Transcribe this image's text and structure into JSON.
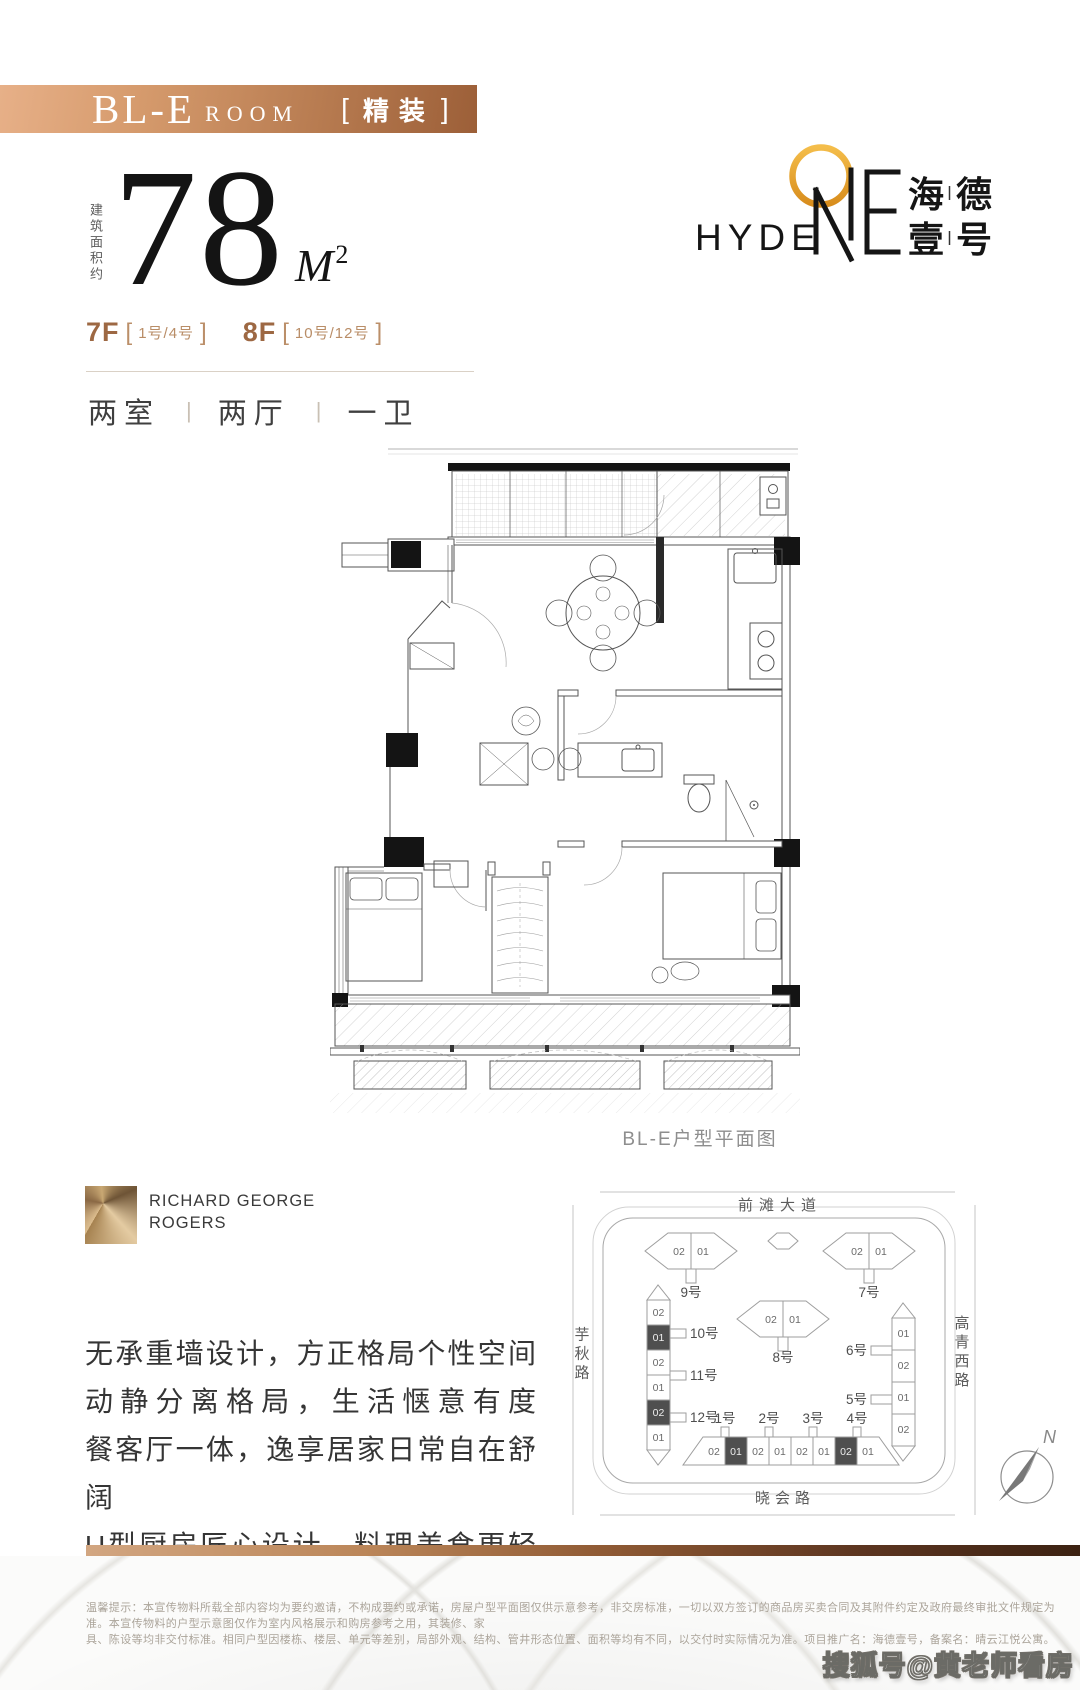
{
  "banner": {
    "model": "BL-E",
    "room": "ROOM",
    "bracket_open": "[",
    "tag": "精装",
    "bracket_close": "]"
  },
  "area": {
    "label_vertical": "建筑面积约",
    "value": "78",
    "unit": "M",
    "sup": "2"
  },
  "floors": {
    "f1": {
      "name": "7F",
      "open": "[",
      "units": "1号/4号",
      "close": "]"
    },
    "f2": {
      "name": "8F",
      "open": "[",
      "units": "10号/12号",
      "close": "]"
    }
  },
  "specs": {
    "s1": "两室",
    "sep1": "|",
    "s2": "两厅",
    "sep2": "|",
    "s3": "一卫"
  },
  "logo": {
    "hyde": "HYDE",
    "cn1": "海",
    "cn2": "德",
    "cn3": "壹",
    "cn4": "号"
  },
  "floorplan": {
    "caption": "BL-E户型平面图"
  },
  "architect": {
    "line1": "RICHARD GEORGE",
    "line2": "ROGERS"
  },
  "description": {
    "line1": "无承重墙设计，方正格局个性空间",
    "line2": "动静分离格局，生活惬意有度",
    "line3": "餐客厅一体，逸享居家日常自在舒阔",
    "line4": "U型厨房匠心设计，料理美食更轻松"
  },
  "sitemap": {
    "roads": {
      "top": "前滩大道",
      "bottom": "晓会路",
      "left": "芋秋路",
      "right": "高青西路"
    },
    "hex9": {
      "name": "9号",
      "c1": "02",
      "c2": "01"
    },
    "hex7": {
      "name": "7号",
      "c1": "02",
      "c2": "01"
    },
    "hex8": {
      "name": "8号",
      "c1": "02",
      "c2": "01"
    },
    "left_strip": {
      "b10": "10号",
      "b11": "11号",
      "b12": "12号",
      "cells": [
        "02",
        "01",
        "02",
        "01",
        "02",
        "01"
      ],
      "dark_cells": [
        1,
        4
      ]
    },
    "right_strip": {
      "b6": "6号",
      "b5": "5号",
      "cells": [
        "01",
        "02",
        "01",
        "02"
      ],
      "dark_cells": []
    },
    "bottom_strip": {
      "b1": "1号",
      "b2": "2号",
      "b3": "3号",
      "b4": "4号",
      "cells": [
        "02",
        "01",
        "02",
        "01",
        "02",
        "01",
        "02",
        "01"
      ],
      "dark_cells": [
        1,
        6
      ]
    },
    "compass": "N"
  },
  "disclaimer": {
    "line1": "温馨提示：本宣传物料所载全部内容均为要约邀请，不构成要约或承诺，房屋户型平面图仅供示意参考，非交房标准，一切以双方签订的商品房买卖合同及其附件约定及政府最终审批文件规定为准。本宣传物料的户型示意图仅作为室内风格展示和购房参考之用，其装修、家",
    "line2": "具、陈设等均非交付标准。相同户型因楼栋、楼层、单元等差别，局部外观、结构、管井形态位置、面积等均有不同，以交付时实际情况为准。项目推广名：海德壹号，备案名：晴云江悦公寓。"
  },
  "watermark": "搜狐号@黄老师看房",
  "colors": {
    "banner_gradient_start": "#e7b088",
    "banner_gradient_end": "#9c5f38",
    "accent_bronze": "#9d6843",
    "logo_gold": "#e9a82f",
    "bar_gradient_start": "#d2a681",
    "bar_gradient_end": "#3c2212",
    "dark_cell": "#4f4f4f"
  }
}
